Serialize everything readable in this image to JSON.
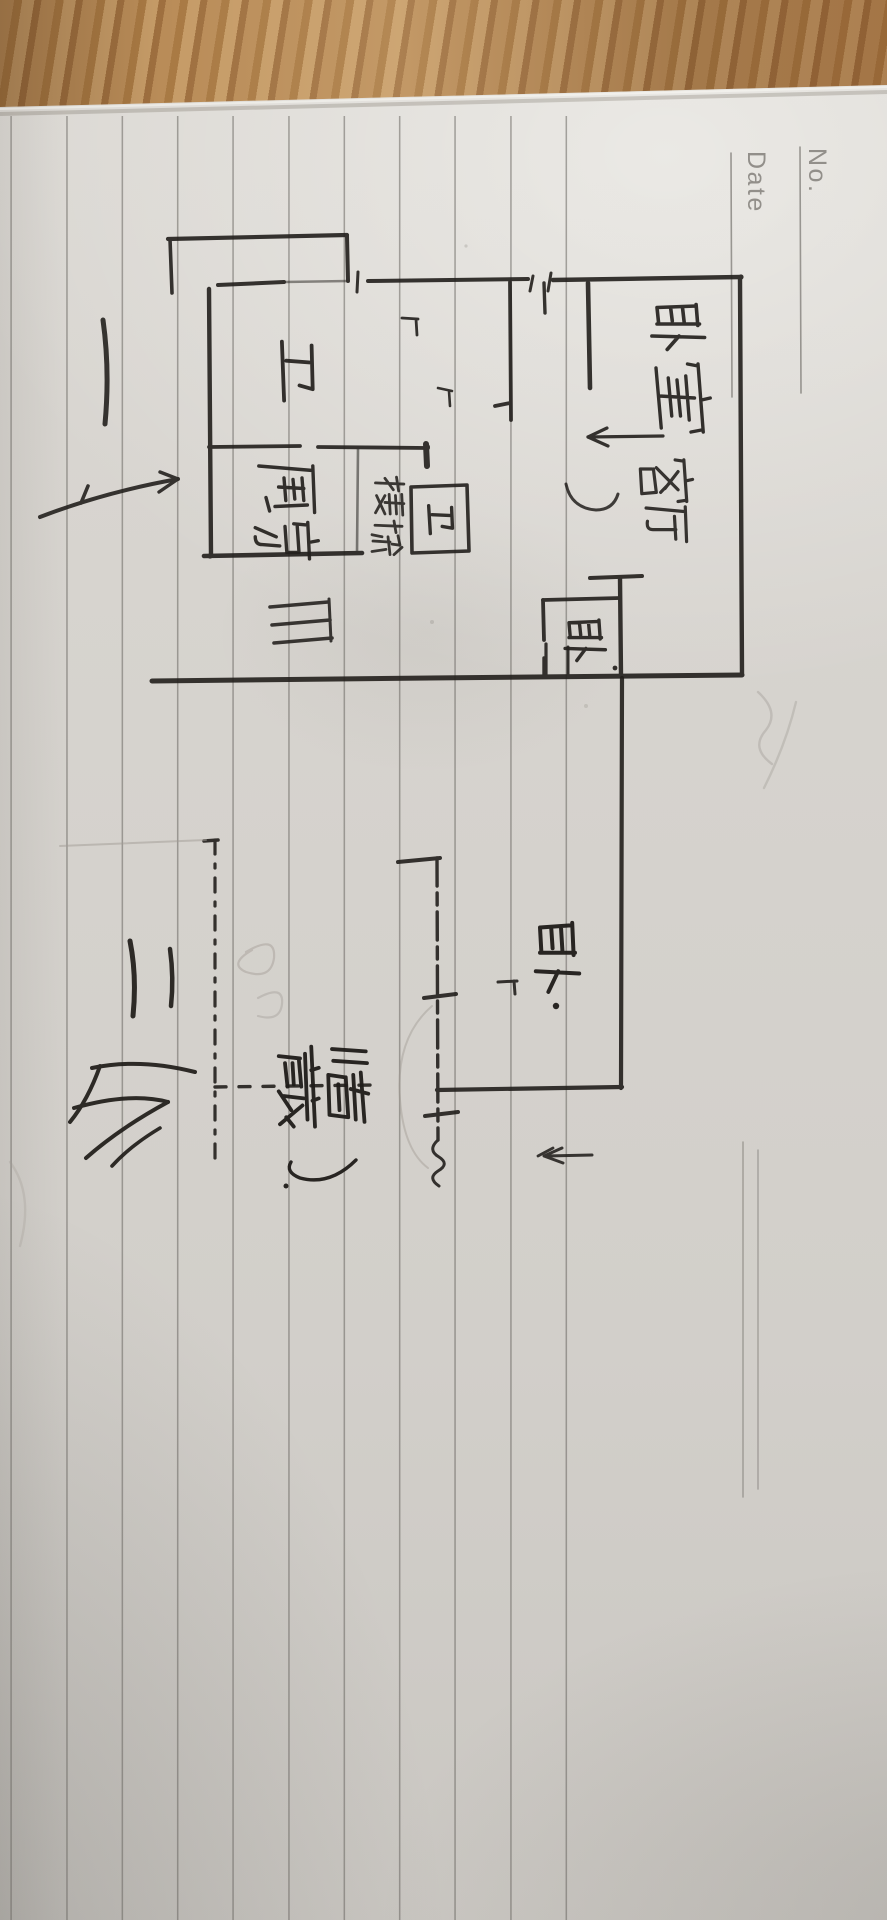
{
  "notebook": {
    "no_label": "No.",
    "date_label": "Date"
  },
  "sketch": {
    "medium": "black ink pen on ruled notebook paper, photographed rotated 90 degrees",
    "floor1": {
      "label": {
        "text": "一层",
        "translation": "First floor"
      },
      "rooms": [
        {
          "text": "卧室",
          "translation": "Bedroom (master)"
        },
        {
          "text": "卫",
          "translation": "Bathroom"
        },
        {
          "text": "厨房",
          "translation": "Kitchen"
        },
        {
          "text": "楼梯",
          "translation": "Stairs"
        },
        {
          "text": "客厅",
          "translation": "Living room"
        },
        {
          "text": "卫",
          "translation": "Bathroom (small, boxed)"
        },
        {
          "text": "卧",
          "translation": "Bedroom (small, boxed)"
        }
      ]
    },
    "floor2": {
      "label": {
        "text": "二层",
        "translation": "Second floor"
      },
      "rooms": [
        {
          "text": "卧.",
          "translation": "Bedroom"
        },
        {
          "text": "储藏室.",
          "translation": "Storage room"
        }
      ]
    }
  },
  "colors": {
    "paper": "#d7d4cf",
    "wood_desk": "#b08350",
    "rule_line": "#8f8c87",
    "ink": "#221f1c",
    "printed_gray": "#928f8a",
    "pencil": "#a19c95"
  }
}
